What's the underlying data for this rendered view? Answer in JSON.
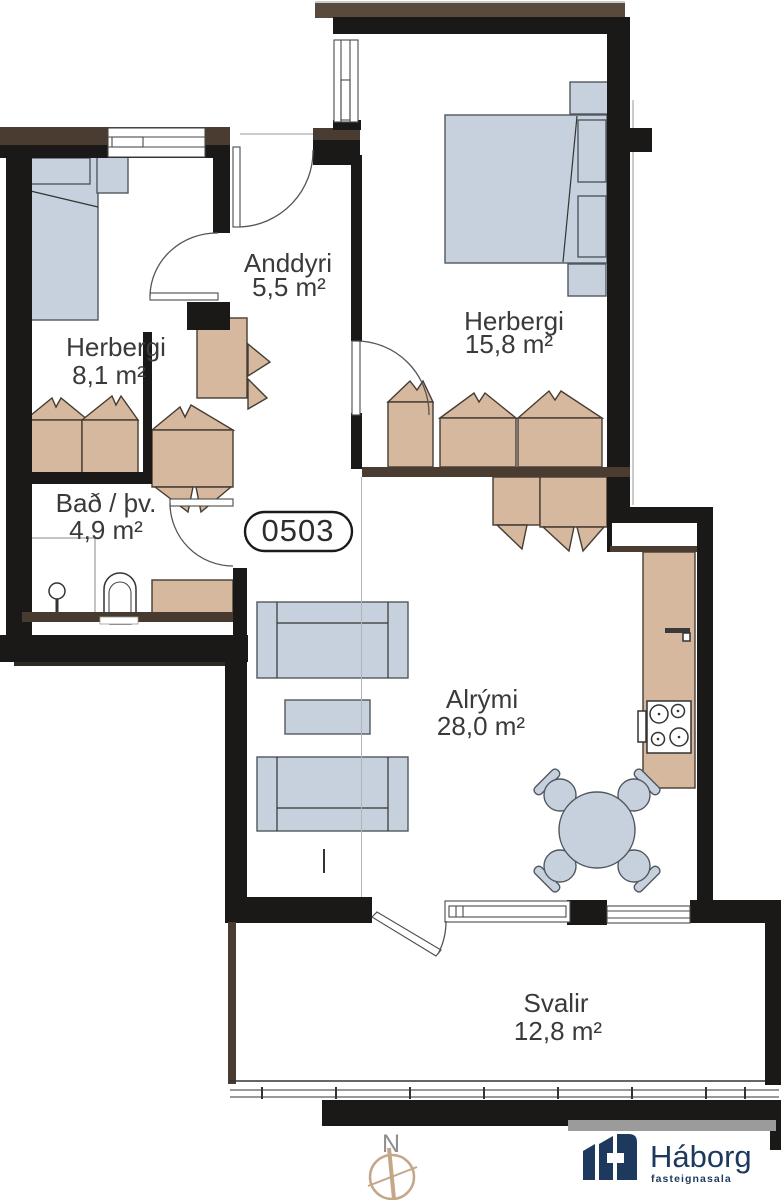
{
  "floor_plan": {
    "unit_number": "0503",
    "rooms": [
      {
        "name": "Herbergi",
        "area": "8,1 m²"
      },
      {
        "name": "Anddyri",
        "area": "5,5 m²"
      },
      {
        "name": "Herbergi",
        "area": "15,8 m²"
      },
      {
        "name": "Bað / þv.",
        "area": "4,9 m²"
      },
      {
        "name": "Alrými",
        "area": "28,0 m²"
      },
      {
        "name": "Svalir",
        "area": "12,8 m²"
      }
    ],
    "compass": {
      "north_label": "N"
    },
    "branding": {
      "name": "Háborg",
      "tagline": "fasteignasala"
    },
    "colors": {
      "wall_black": "#1b1917",
      "wall_brown": "#4a3c30",
      "furniture_wood": "#d5b89e",
      "furniture_blue": "#c7d1dd",
      "brand_navy": "#1d3a5e",
      "compass_tan": "#c4a789",
      "label_gray": "#3a3a3a"
    }
  }
}
